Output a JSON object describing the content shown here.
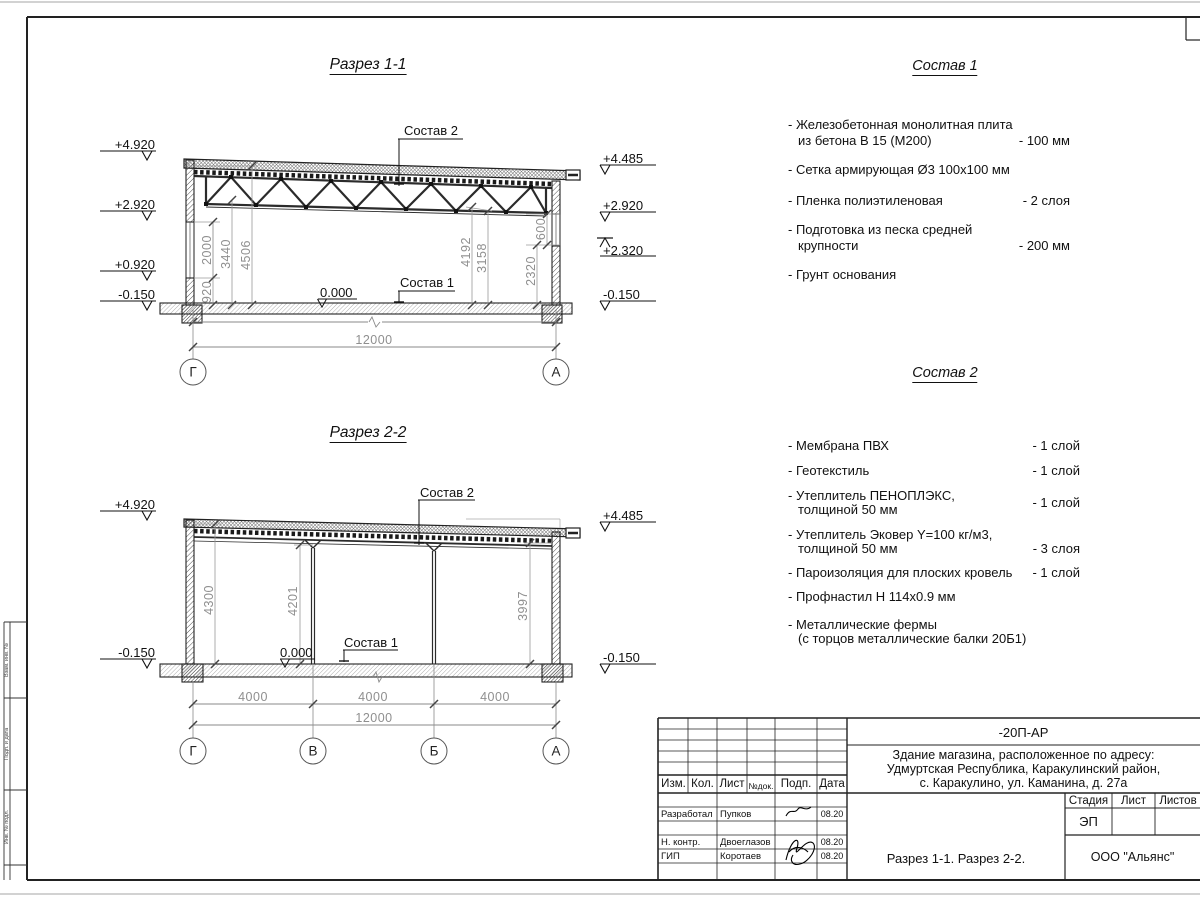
{
  "s1": {
    "title": "Разрез 1-1",
    "label_sostav2": "Состав 2",
    "label_sostav1": "Состав 1",
    "zero_mark": "0.000",
    "elev_left": [
      "+4.920",
      "+2.920",
      "+0.920",
      "-0.150"
    ],
    "elev_right": [
      "+4.485",
      "+2.920",
      "+2.320",
      "-0.150"
    ],
    "dims_left": [
      "2000",
      "920",
      "3440",
      "4506"
    ],
    "dims_right": [
      "4192",
      "3158",
      "2320",
      "600"
    ],
    "dim_total": "12000",
    "axes": [
      "Г",
      "А"
    ]
  },
  "s2": {
    "title": "Разрез 2-2",
    "label_sostav2": "Состав 2",
    "label_sostav1": "Состав 1",
    "zero_mark": "0.000",
    "elev_left": [
      "+4.920",
      "-0.150"
    ],
    "elev_right": [
      "+4.485",
      "-0.150"
    ],
    "dims_inner": [
      "4300",
      "4201",
      "3997"
    ],
    "dims_span": [
      "4000",
      "4000",
      "4000"
    ],
    "dim_total": "12000",
    "axes": [
      "Г",
      "В",
      "Б",
      "А"
    ]
  },
  "list1": {
    "heading": "Состав 1",
    "r1a": "- Железобетонная  монолитная плита",
    "r1b": "из бетона В 15 (М200)",
    "r1v": "- 100 мм",
    "r2": "- Сетка армирующая Ø3 100х100 мм",
    "r3": "- Пленка полиэтиленовая",
    "r3v": "-  2 слоя",
    "r4a": "- Подготовка из песка средней",
    "r4b": "крупности",
    "r4v": "- 200 мм",
    "r5": "- Грунт основания"
  },
  "list2": {
    "heading": "Состав 2",
    "r1": "- Мембрана ПВХ",
    "r1v": "- 1 слой",
    "r2": "- Геотекстиль",
    "r2v": "- 1 слой",
    "r3a": "- Утеплитель ПЕНОПЛЭКС,",
    "r3b": "толщиной 50 мм",
    "r3v": "- 1 слой",
    "r4a": "- Утеплитель Эковер Y=100 кг/м3,",
    "r4b": "толщиной 50 мм",
    "r4v": "- 3 слоя",
    "r5": "- Пароизоляция для плоских кровель",
    "r5v": "- 1 слой",
    "r6": "- Профнастил Н 114х0.9 мм",
    "r7a": "- Металлические фермы",
    "r7b": "(с торцов металлические балки 20Б1)"
  },
  "tb": {
    "doc_code": "-20П-АР",
    "project_line1": "Здание магазина, расположенное по адресу:",
    "project_line2": "Удмуртская Республика, Каракулинский район,",
    "project_line3": "с. Каракулино, ул. Каманина, д. 27а",
    "col_izm": "Изм.",
    "col_kol": "Кол.",
    "col_list": "Лист",
    "col_ndok": "№док.",
    "col_podp": "Подп.",
    "col_data": "Дата",
    "row1_role": "Разработал",
    "row1_name": "Пупков",
    "row1_date": "08.20",
    "row2_role": "Н. контр.",
    "row2_name": "Двоеглазов",
    "row2_date": "08.20",
    "row3_role": "ГИП",
    "row3_name": "Коротаев",
    "row3_date": "08.20",
    "stage_label": "Стадия",
    "sheet_label": "Лист",
    "sheets_label": "Листов",
    "stage_value": "ЭП",
    "drawing_name": "Разрез 1-1. Разрез 2-2.",
    "company": "ООО \"Альянс\""
  },
  "stamp": {
    "c1": "Взам. инв. №",
    "c2": "Подп. и дата",
    "c3": "Инв. № подл."
  }
}
